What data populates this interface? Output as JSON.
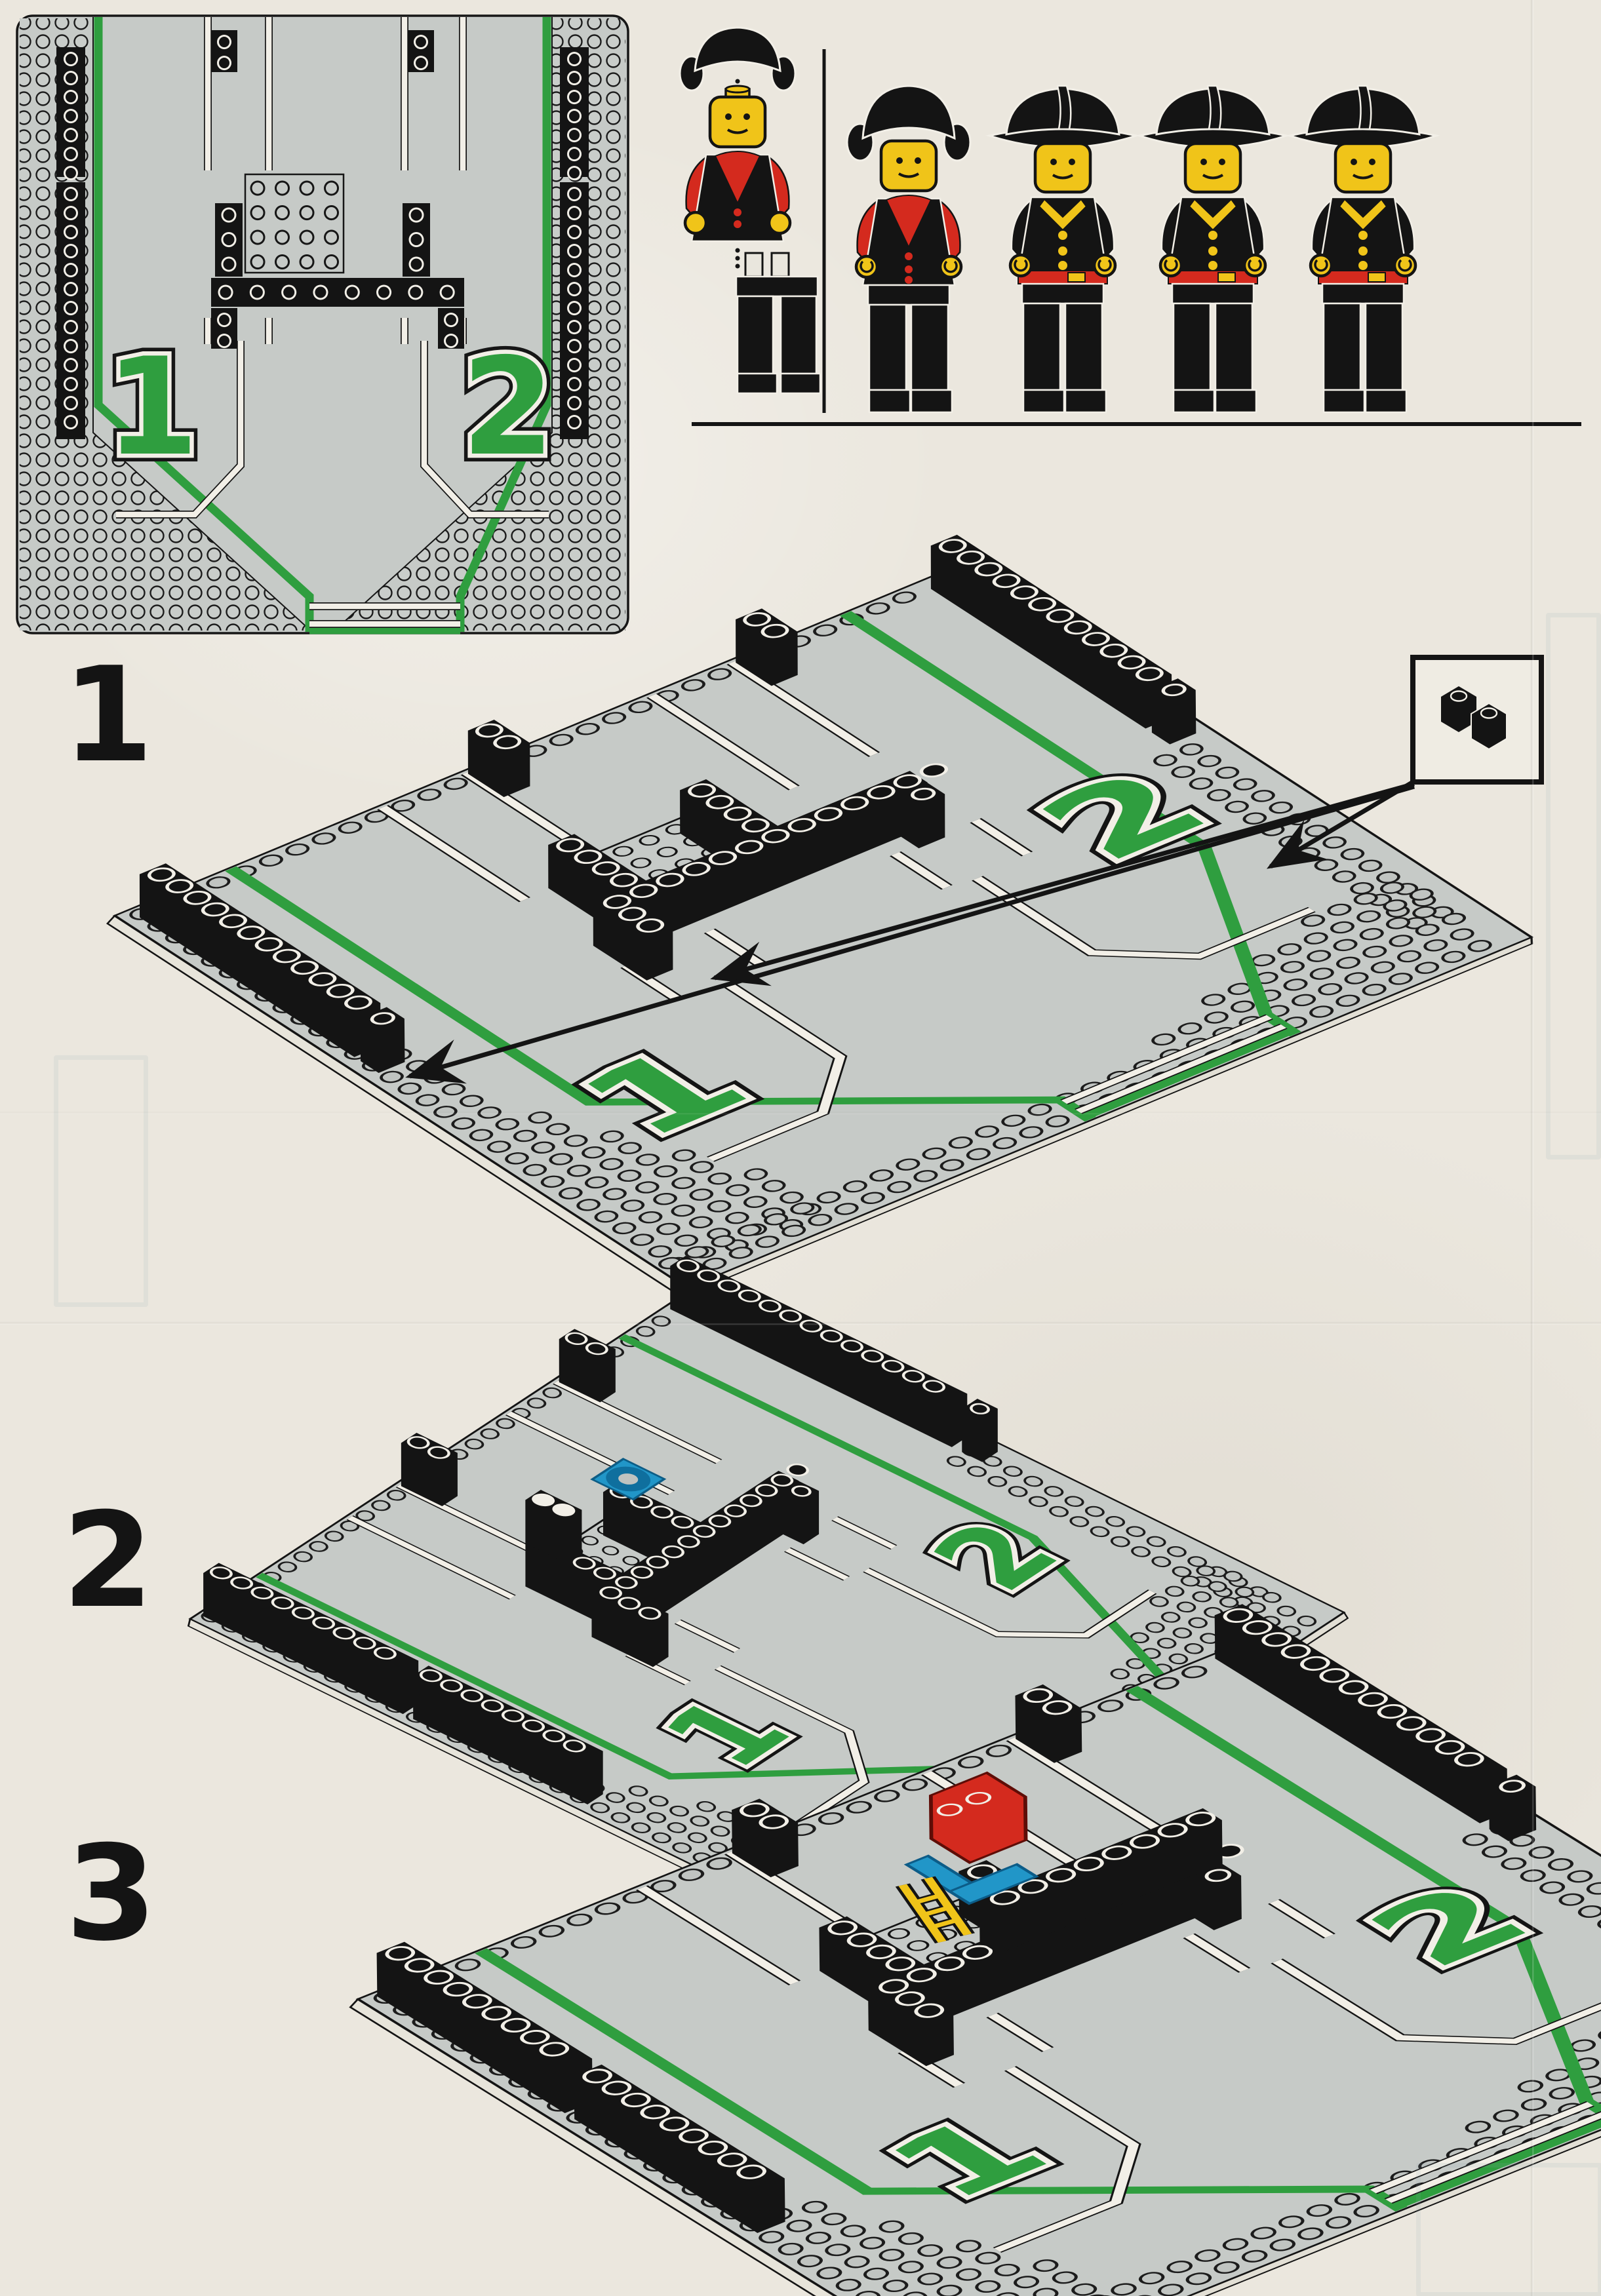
{
  "page": {
    "type": "lego-building-instructions-scan",
    "background": "#ebe7de"
  },
  "plan_diagram": {
    "description": "top-down-road-plate",
    "bay_numbers": {
      "bay1": "1",
      "bay2": "2"
    }
  },
  "figures": {
    "items": [
      {
        "name": "female-figure-exploded",
        "parts": [
          "pigtail-hair",
          "head",
          "torso-red-arms",
          "legs"
        ]
      },
      {
        "name": "female-figure-assembled"
      },
      {
        "name": "fireman-figure-1"
      },
      {
        "name": "fireman-figure-2"
      },
      {
        "name": "fireman-figure-3"
      }
    ]
  },
  "steps": [
    {
      "label": "1",
      "bay1": "1",
      "bay2": "2",
      "callout_icon": "two-1x1-black-bricks"
    },
    {
      "label": "2",
      "bay1": "1",
      "bay2": "2",
      "new_part": "blue-turntable-base"
    },
    {
      "label": "3",
      "bay1": "1",
      "bay2": "2",
      "new_parts": [
        "yellow-ladder",
        "blue-seat",
        "red-brick"
      ]
    }
  ],
  "colors": {
    "paper": "#ebe7de",
    "asphalt": "#c6cac7",
    "stripe_green": "#2f9e3f",
    "brick_black": "#141414",
    "marking_white": "#f2efe7",
    "fig_yellow": "#f0c419",
    "fig_red": "#d42a1e",
    "part_blue": "#2196c8"
  }
}
